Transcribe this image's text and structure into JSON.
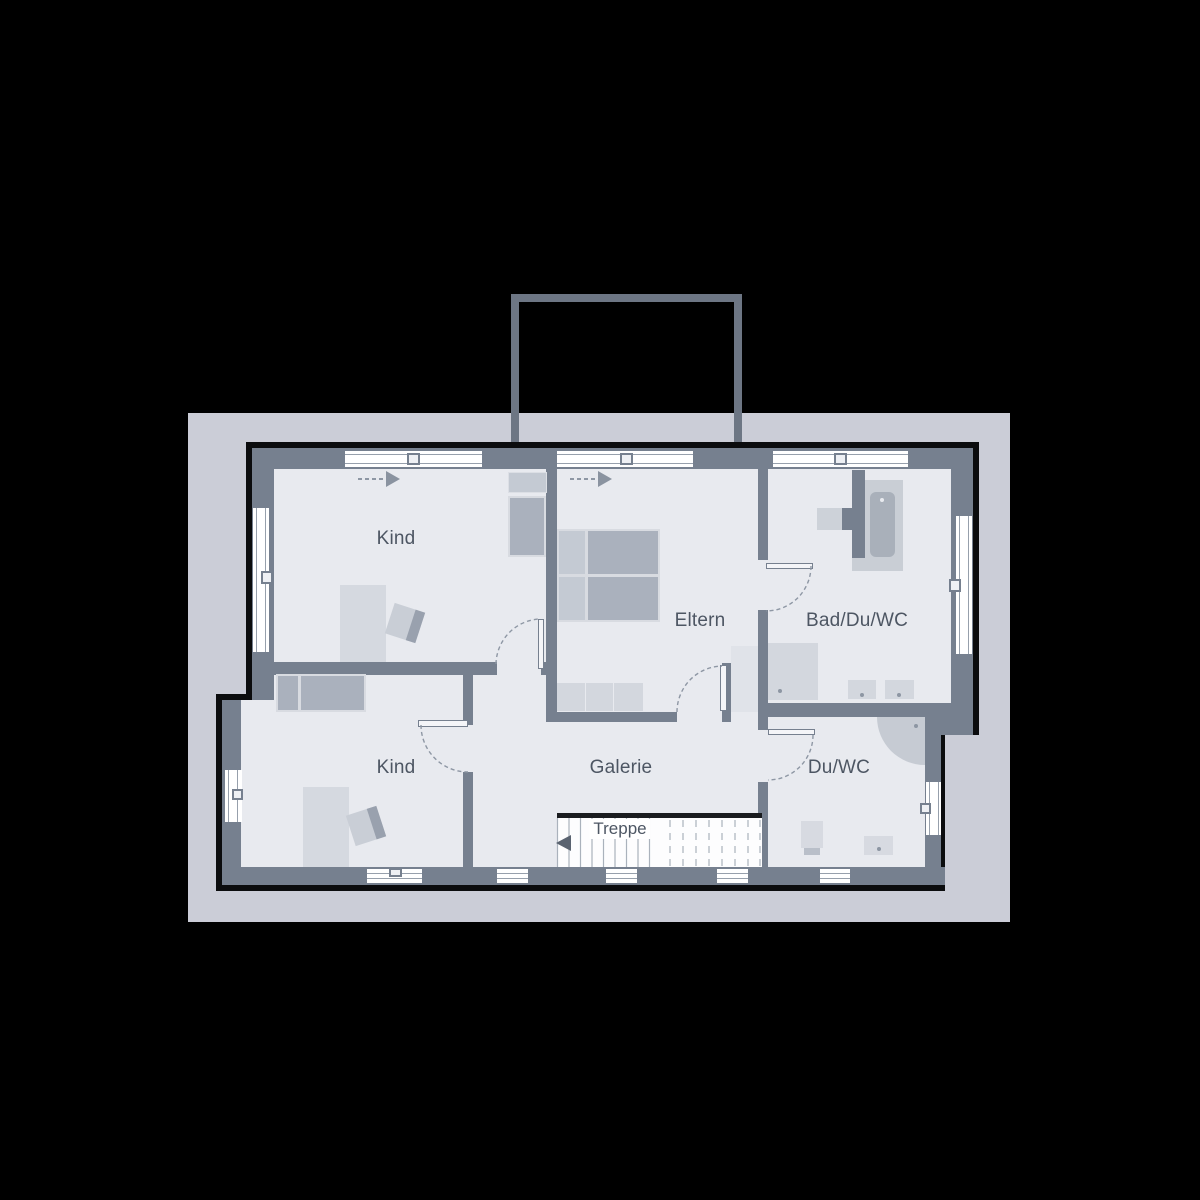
{
  "rooms": {
    "kind_top": {
      "label": "Kind"
    },
    "eltern": {
      "label": "Eltern"
    },
    "bad": {
      "label": "Bad/Du/WC"
    },
    "kind_bottom": {
      "label": "Kind"
    },
    "galerie": {
      "label": "Galerie"
    },
    "du_wc": {
      "label": "Du/WC"
    }
  },
  "stairs": {
    "label": "Treppe"
  },
  "colors": {
    "background": "#000000",
    "site_surround": "#cbcdd7",
    "floor": "#e8eaef",
    "wall": "#76808f",
    "outline": "#0b0c0e",
    "furniture_dark": "#aab1bd",
    "furniture_light": "#d5d9e0",
    "label_text": "#4d5663",
    "door_swing_dash": "#8e97a4",
    "chimney_line": "#6d7684"
  }
}
